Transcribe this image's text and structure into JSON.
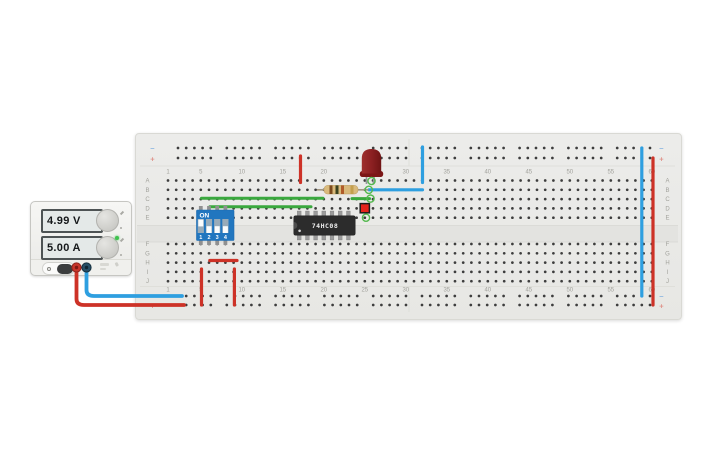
{
  "power_supply": {
    "voltage": "4.99 V",
    "current": "5.00 A"
  },
  "breadboard": {
    "column_numbers": [
      "1",
      "5",
      "10",
      "15",
      "20",
      "25",
      "30",
      "35",
      "40",
      "45",
      "50",
      "55",
      "60"
    ],
    "row_letters_top": [
      "A",
      "B",
      "C",
      "D",
      "E"
    ],
    "row_letters_bottom": [
      "F",
      "G",
      "H",
      "I",
      "J"
    ],
    "negative_symbol": "−",
    "positive_symbol": "+"
  },
  "ic": {
    "label": "74HC08"
  },
  "dip_switch": {
    "on_label": "ON",
    "pin_labels": [
      "1",
      "2",
      "3",
      "4"
    ],
    "states": [
      "on",
      "off",
      "off",
      "off"
    ]
  },
  "colors": {
    "wire": {
      "red": "#cd3227",
      "blue": "#2e9fe0",
      "green": "#3aa83e"
    },
    "dip_blue": "#2176bf",
    "led_red": "#8c2022",
    "switch_red": "#e5231c",
    "highlight_green": "#54b94e",
    "resistor_bands": [
      "#7c4a1e",
      "#3a421f",
      "#b05c2b",
      "#c39f4e"
    ]
  },
  "wires": [
    {
      "name": "psu-negative-wire",
      "color": "blue",
      "width": 3.8,
      "d": "M86.5 266 L86.5 290 Q86.5 296 94 296 L182 296"
    },
    {
      "name": "psu-positive-wire",
      "color": "red",
      "width": 3.8,
      "d": "M76.5 266 L76.5 299 Q76.5 305 84 305 L184 305"
    },
    {
      "name": "rail-bridge-negative",
      "color": "blue",
      "width": 3.2,
      "d": "M641.8 148 L641.8 296"
    },
    {
      "name": "rail-bridge-positive",
      "color": "red",
      "width": 3.2,
      "d": "M653 158 L653 305"
    },
    {
      "name": "ic-vcc-jumper",
      "color": "red",
      "width": 3.2,
      "d": "M300.5 156 L300.5 182.5"
    },
    {
      "name": "gnd-jumper-vertical",
      "color": "blue",
      "width": 3.2,
      "d": "M422.5 147 L422.5 182.5"
    },
    {
      "name": "gnd-jumper-row-b",
      "color": "blue",
      "width": 3.2,
      "d": "M369 189.8 L422.5 189.8"
    },
    {
      "name": "signal-wire-row-c",
      "color": "green",
      "width": 3,
      "d": "M201.5 198.2 L323 198.2"
    },
    {
      "name": "signal-wire-row-d",
      "color": "green",
      "width": 3,
      "d": "M209.8 206.8 L311 206.8"
    },
    {
      "name": "output-wire-row-c",
      "color": "green",
      "width": 3,
      "d": "M352 198.6 L369.5 198.6"
    },
    {
      "name": "power-jumper-row-h",
      "color": "red",
      "width": 3.2,
      "d": "M209.8 260.5 L237 260.5"
    },
    {
      "name": "power-jumper-col5",
      "color": "red",
      "width": 3.2,
      "d": "M201.5 269 L201.5 305"
    },
    {
      "name": "power-jumper-col9",
      "color": "red",
      "width": 3.2,
      "d": "M234.4 269 L234.4 305"
    }
  ],
  "highlights": [
    [
      371.5,
      181
    ],
    [
      368.8,
      189.8
    ],
    [
      370.5,
      198.6
    ],
    [
      366,
      217.7
    ]
  ]
}
